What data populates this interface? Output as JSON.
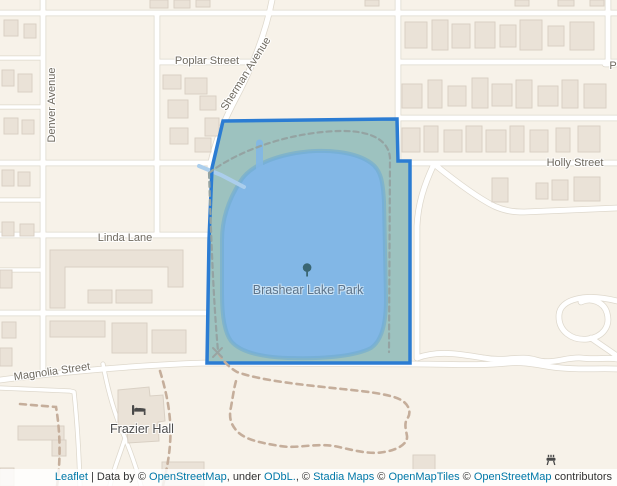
{
  "map": {
    "street_labels": {
      "poplar": "Poplar Street",
      "sherman": "Sherman Avenue",
      "denver": "Denver Avenue",
      "holly": "Holly Street",
      "linda": "Linda Lane",
      "magnolia": "Magnolia Street",
      "partial_p": "P"
    },
    "poi_labels": {
      "park": "Brashear Lake Park",
      "hall": "Frazier Hall"
    },
    "colors": {
      "land": "#f7f2e9",
      "road": "#ffffff",
      "road_casing": "#ded8cc",
      "building": "#eae2d7",
      "building_edge": "#d9d0c4",
      "park_fill": "#9dc2bf",
      "park_border": "#2b7cd3",
      "water": "#82b7e6",
      "water_edge": "#72accf",
      "trail": "#c5ae9b",
      "park_trail": "#94a3a2",
      "label": "#6f6a60",
      "water_label": "#5d7389",
      "poi_label": "#4d4d4d",
      "icon": "#4a4a4a",
      "tree": "#3a6673",
      "link": "#0078a8",
      "attribution_text": "#333333"
    }
  },
  "attribution": {
    "parts": [
      {
        "text": "Leaflet",
        "link": true
      },
      {
        "text": " | ",
        "link": false
      },
      {
        "text": "Data by © ",
        "link": false
      },
      {
        "text": "OpenStreetMap",
        "link": true
      },
      {
        "text": ", under ",
        "link": false
      },
      {
        "text": "ODbL.",
        "link": true
      },
      {
        "text": ", © ",
        "link": false
      },
      {
        "text": "Stadia Maps",
        "link": true
      },
      {
        "text": " © ",
        "link": false
      },
      {
        "text": "OpenMapTiles",
        "link": true
      },
      {
        "text": " © ",
        "link": false
      },
      {
        "text": "OpenStreetMap",
        "link": true
      },
      {
        "text": " contributors",
        "link": false
      }
    ]
  }
}
